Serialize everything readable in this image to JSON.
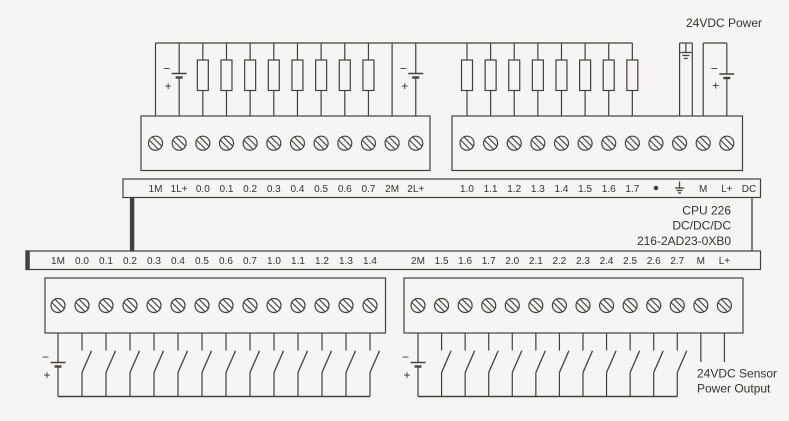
{
  "colors": {
    "background": "#f6f5f3",
    "line": "#45403c",
    "text": "#37332e"
  },
  "labels": {
    "power": "24VDC Power",
    "sensor": [
      "24VDC Sensor",
      "Power Output"
    ],
    "cpu": [
      "CPU 226",
      "DC/DC/DC",
      "216-2AD23-0XB0"
    ],
    "battery_minus": "−",
    "battery_plus": "+"
  },
  "top_strip": {
    "labels": [
      "1M",
      "1L+",
      "0.0",
      "0.1",
      "0.2",
      "0.3",
      "0.4",
      "0.5",
      "0.6",
      "0.7",
      "2M",
      "2L+",
      "1.0",
      "1.1",
      "1.2",
      "1.3",
      "1.4",
      "1.5",
      "1.6",
      "1.7",
      "•",
      "⏚",
      "M",
      "L+",
      "DC"
    ]
  },
  "bottom_strip": {
    "labels": [
      "1M",
      "0.0",
      "0.1",
      "0.2",
      "0.3",
      "0.4",
      "0.5",
      "0.6",
      "0.7",
      "1.0",
      "1.1",
      "1.2",
      "1.3",
      "1.4",
      "2M",
      "1.5",
      "1.6",
      "1.7",
      "2.0",
      "2.1",
      "2.2",
      "2.3",
      "2.4",
      "2.5",
      "2.6",
      "2.7",
      "M",
      "L+"
    ]
  }
}
